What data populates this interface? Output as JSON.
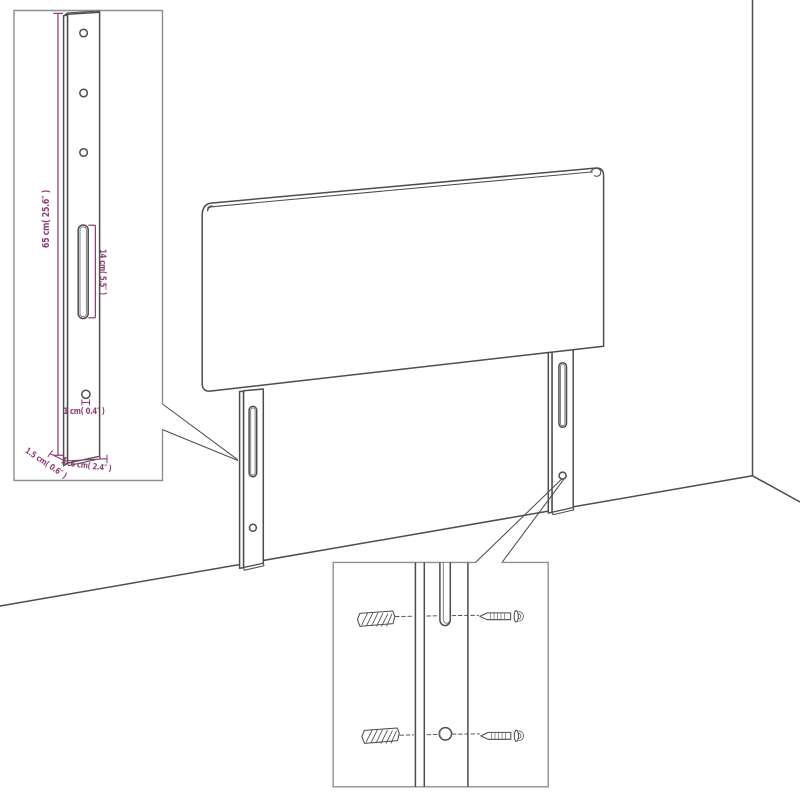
{
  "diagram": {
    "kind": "headboard-assembly-dimension-diagram",
    "views": {
      "main": "headboard panel with two wall-mount legs in room corner perspective",
      "inset_top_left": "magnified side post with mounting holes, slot and dimension callouts",
      "inset_bottom": "magnified leg slot and hole with wall plugs and screws"
    }
  },
  "labels": {
    "height": "65 cm( 25.6″ )",
    "slot": "14 cm( 5.5″ )",
    "hole": "1 cm( 0.4″ )",
    "depth": "1.5 cm( 0.6″ )",
    "width": "6 cm( 2.4″ )"
  },
  "colors": {
    "line": "#4d4d4d",
    "box_border": "#8f8f8f",
    "accent": "#8e3d76",
    "background": "#ffffff"
  }
}
